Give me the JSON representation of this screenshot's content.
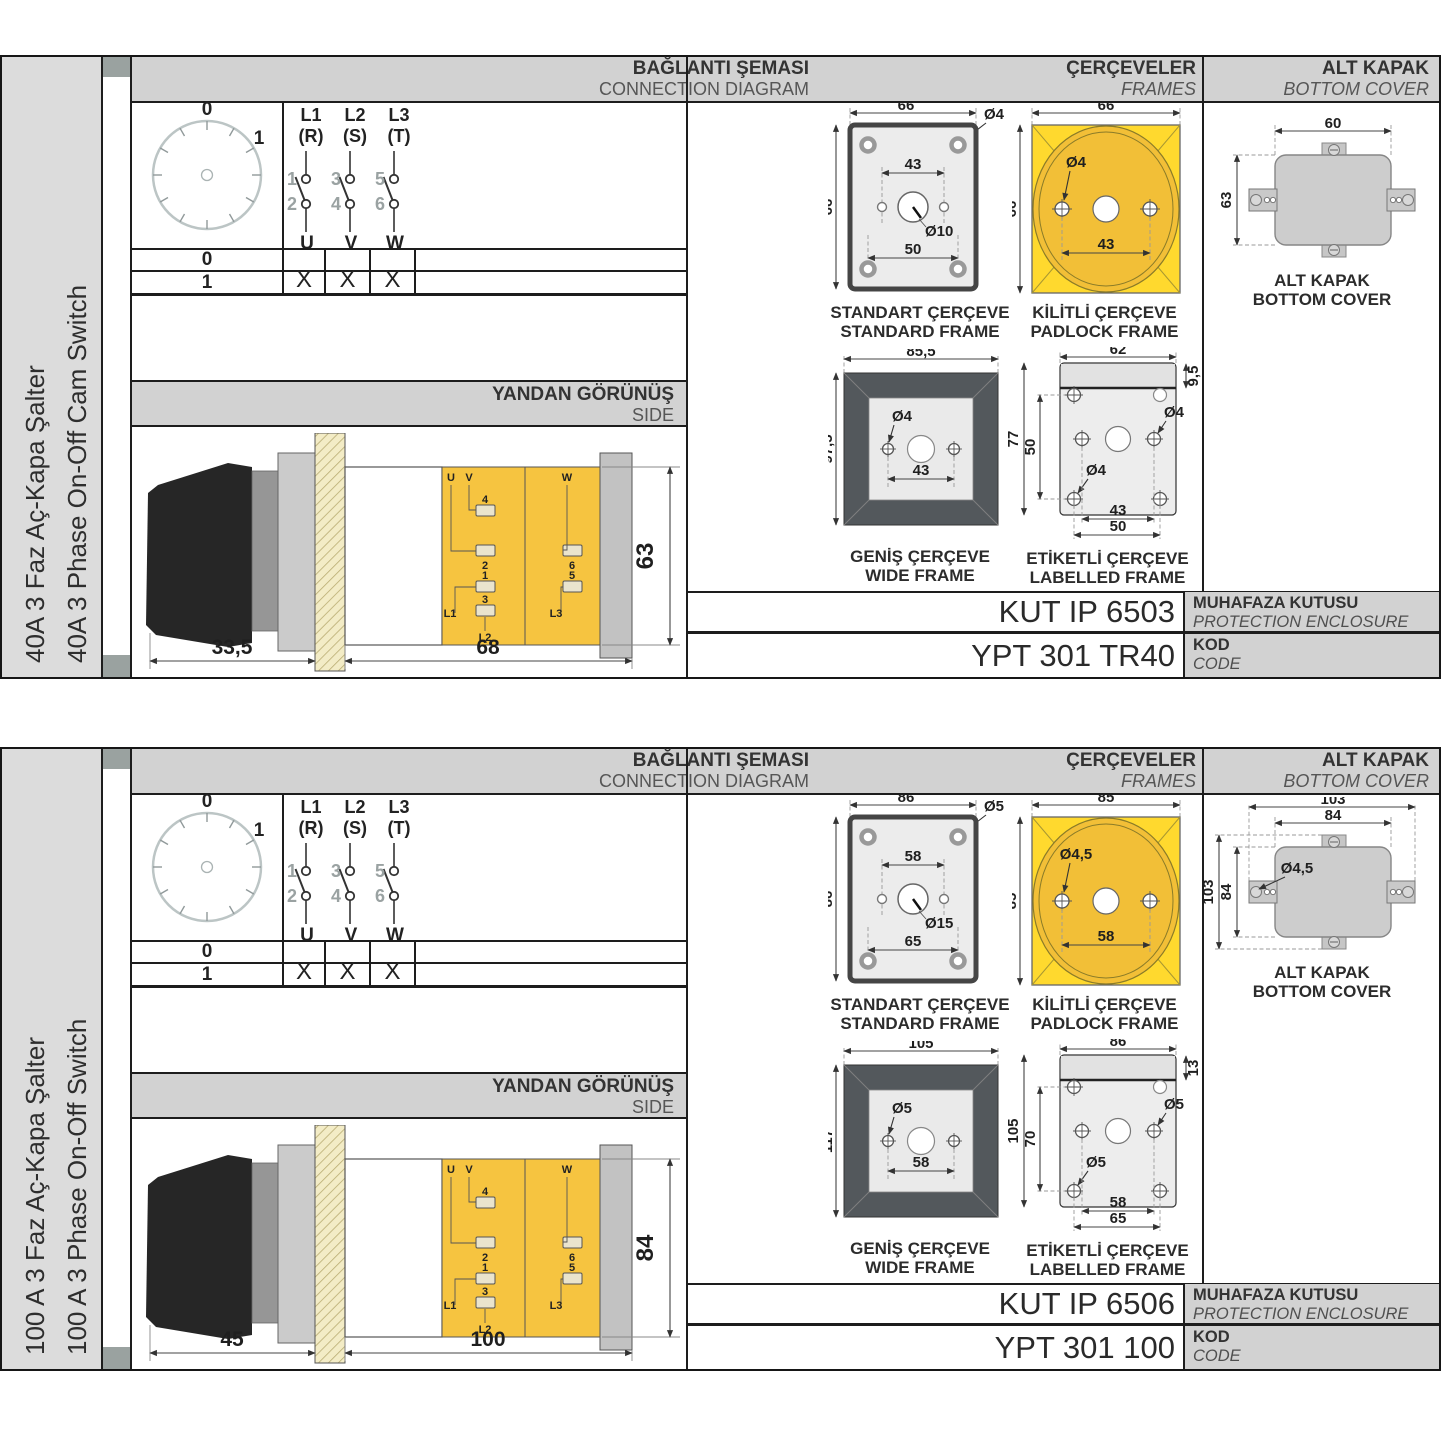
{
  "panels": [
    {
      "side_label_tr": "40A 3 Faz Aç-Kapa Şalter",
      "side_label_en": "40A 3 Phase On-Off Cam Switch",
      "headers": {
        "connection": {
          "title": "BAĞLANTI ŞEMASI",
          "subtitle": "CONNECTION DIAGRAM"
        },
        "frames": {
          "title": "ÇERÇEVELER",
          "subtitle": "FRAMES"
        },
        "cover": {
          "title": "ALT KAPAK",
          "subtitle": "BOTTOM COVER"
        }
      },
      "diagram": {
        "dial": {
          "off": "0",
          "on": "1"
        },
        "poles": [
          {
            "line": "L1",
            "phase": "(R)",
            "n_in": "1",
            "n_out": "2",
            "out": "U"
          },
          {
            "line": "L2",
            "phase": "(S)",
            "n_in": "3",
            "n_out": "4",
            "out": "V"
          },
          {
            "line": "L3",
            "phase": "(T)",
            "n_in": "5",
            "n_out": "6",
            "out": "W"
          }
        ],
        "table": {
          "rows": [
            {
              "pos": "0",
              "u": "",
              "v": "",
              "w": ""
            },
            {
              "pos": "1",
              "u": "X",
              "v": "X",
              "w": "X"
            }
          ]
        }
      },
      "side_view": {
        "title": "YANDAN GÖRÜNÜŞ",
        "subtitle": "SIDE",
        "dims": {
          "handle": "33,5",
          "body": "68",
          "height": "63"
        },
        "terminals": {
          "u": "U",
          "v": "V",
          "w": "W",
          "t4": "4",
          "t2": "2",
          "t6": "6",
          "t1": "1",
          "t5": "5",
          "t3": "3",
          "l1": "L1",
          "l2": "L2",
          "l3": "L3"
        }
      },
      "frames": {
        "standard": {
          "caption_tr": "STANDART ÇERÇEVE",
          "caption_en": "STANDARD FRAME",
          "w": "66",
          "h": "66",
          "hole": "Ø4",
          "c1": "43",
          "center": "Ø10",
          "c2": "50"
        },
        "padlock": {
          "caption_tr": "KİLİTLİ ÇERÇEVE",
          "caption_en": "PADLOCK FRAME",
          "w": "66",
          "h": "66",
          "hole": "Ø4",
          "c1": "43"
        },
        "wide": {
          "caption_tr": "GENİŞ ÇERÇEVE",
          "caption_en": "WIDE FRAME",
          "w": "85,5",
          "h": "97,5",
          "hole": "Ø4",
          "c1": "43"
        },
        "labelled": {
          "caption_tr": "ETİKETLİ ÇERÇEVE",
          "caption_en": "LABELLED FRAME",
          "w": "62",
          "band": "9,5",
          "h": "77",
          "inner_h": "50",
          "hole1": "Ø4",
          "hole2": "Ø4",
          "c1": "43",
          "c2": "50"
        }
      },
      "cover": {
        "caption_tr": "ALT KAPAK",
        "caption_en": "BOTTOM COVER",
        "w": "60",
        "h": "63",
        "w_outer": null,
        "h_outer": null,
        "hole": null
      },
      "enclosure": {
        "value": "KUT IP 6503",
        "label_tr": "MUHAFAZA KUTUSU",
        "label_en": "PROTECTION ENCLOSURE"
      },
      "code": {
        "value": "YPT 301 TR40",
        "label_tr": "KOD",
        "label_en": "CODE"
      }
    },
    {
      "side_label_tr": "100 A 3 Faz Aç-Kapa Şalter",
      "side_label_en": "100 A 3 Phase On-Off Switch",
      "headers": {
        "connection": {
          "title": "BAĞLANTI ŞEMASI",
          "subtitle": "CONNECTION DIAGRAM"
        },
        "frames": {
          "title": "ÇERÇEVELER",
          "subtitle": "FRAMES"
        },
        "cover": {
          "title": "ALT KAPAK",
          "subtitle": "BOTTOM COVER"
        }
      },
      "diagram": {
        "dial": {
          "off": "0",
          "on": "1"
        },
        "poles": [
          {
            "line": "L1",
            "phase": "(R)",
            "n_in": "1",
            "n_out": "2",
            "out": "U"
          },
          {
            "line": "L2",
            "phase": "(S)",
            "n_in": "3",
            "n_out": "4",
            "out": "V"
          },
          {
            "line": "L3",
            "phase": "(T)",
            "n_in": "5",
            "n_out": "6",
            "out": "W"
          }
        ],
        "table": {
          "rows": [
            {
              "pos": "0",
              "u": "",
              "v": "",
              "w": ""
            },
            {
              "pos": "1",
              "u": "X",
              "v": "X",
              "w": "X"
            }
          ]
        }
      },
      "side_view": {
        "title": "YANDAN GÖRÜNÜŞ",
        "subtitle": "SIDE",
        "dims": {
          "handle": "45",
          "body": "100",
          "height": "84"
        },
        "terminals": {
          "u": "U",
          "v": "V",
          "w": "W",
          "t4": "4",
          "t2": "2",
          "t6": "6",
          "t1": "1",
          "t5": "5",
          "t3": "3",
          "l1": "L1",
          "l2": "L2",
          "l3": "L3"
        }
      },
      "frames": {
        "standard": {
          "caption_tr": "STANDART ÇERÇEVE",
          "caption_en": "STANDARD FRAME",
          "w": "86",
          "h": "86",
          "hole": "Ø5",
          "c1": "58",
          "center": "Ø15",
          "c2": "65"
        },
        "padlock": {
          "caption_tr": "KİLİTLİ ÇERÇEVE",
          "caption_en": "PADLOCK FRAME",
          "w": "85",
          "h": "85",
          "hole": "Ø4,5",
          "c1": "58"
        },
        "wide": {
          "caption_tr": "GENİŞ ÇERÇEVE",
          "caption_en": "WIDE FRAME",
          "w": "105",
          "h": "117",
          "hole": "Ø5",
          "c1": "58"
        },
        "labelled": {
          "caption_tr": "ETİKETLİ ÇERÇEVE",
          "caption_en": "LABELLED FRAME",
          "w": "86",
          "band": "13",
          "h": "105",
          "inner_h": "70",
          "hole1": "Ø5",
          "hole2": "Ø5",
          "c1": "58",
          "c2": "65"
        }
      },
      "cover": {
        "caption_tr": "ALT KAPAK",
        "caption_en": "BOTTOM COVER",
        "w": "84",
        "h": "84",
        "w_outer": "103",
        "h_outer": "103",
        "hole": "Ø4,5"
      },
      "enclosure": {
        "value": "KUT IP 6506",
        "label_tr": "MUHAFAZA KUTUSU",
        "label_en": "PROTECTION ENCLOSURE"
      },
      "code": {
        "value": "YPT 301 100",
        "label_tr": "KOD",
        "label_en": "CODE"
      }
    }
  ]
}
